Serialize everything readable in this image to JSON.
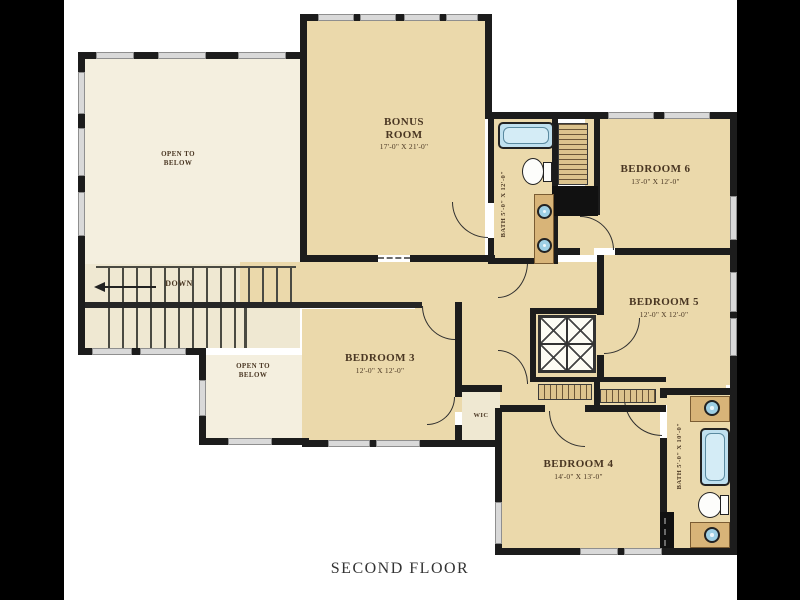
{
  "title": "SECOND FLOOR",
  "rooms": {
    "bonus": {
      "name": "BONUS ROOM",
      "dims": "17'-0\" X 21'-0\""
    },
    "bedroom3": {
      "name": "BEDROOM 3",
      "dims": "12'-0\" X 12'-0\""
    },
    "bedroom4": {
      "name": "BEDROOM 4",
      "dims": "14'-0\" X 13'-0\""
    },
    "bedroom5": {
      "name": "BEDROOM 5",
      "dims": "12'-0\" X 12'-0\""
    },
    "bedroom6": {
      "name": "BEDROOM 6",
      "dims": "13'-0\" X 12'-0\""
    },
    "open_below_top": {
      "name": "OPEN TO BELOW"
    },
    "open_below_bottom": {
      "name": "OPEN TO BELOW"
    },
    "wic": {
      "name": "WIC"
    },
    "bath_top": {
      "name": "BATH",
      "dims": "5'-0\" X 12'-0\""
    },
    "bath_bottom": {
      "name": "BATH",
      "dims": "5'-0\" X 10'-0\""
    },
    "stairs": {
      "label": "DOWN"
    }
  },
  "colors": {
    "wall": "#1c1c1c",
    "room_fill": "#ebd9ab",
    "open_fill": "#f4efdf",
    "fixture_blue": "#bfe0ef",
    "label_text": "#4a3723",
    "background": "#000000"
  }
}
